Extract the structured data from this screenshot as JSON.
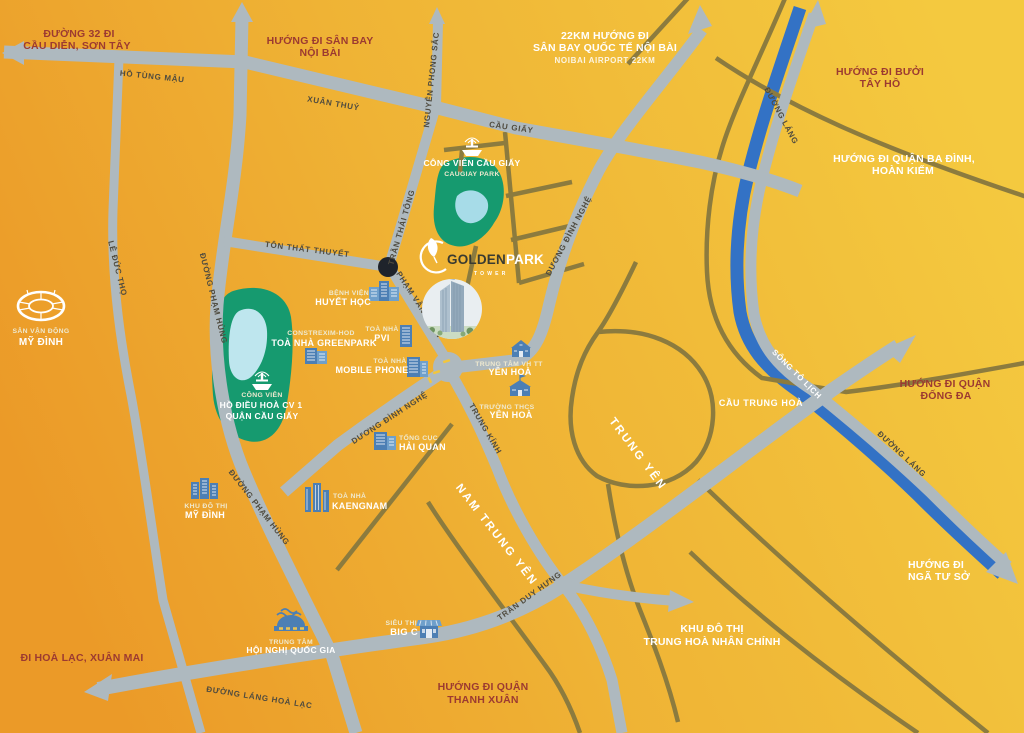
{
  "colors": {
    "bg_orange": "#EC9C2A",
    "bg_gold": "#F4C93F",
    "road_gray": "#AEB9BF",
    "road_minor_olive": "#8C7B3E",
    "river_blue": "#3372C5",
    "park_green": "#169A6F",
    "lake_blue": "#A7DCE8",
    "icon_blue": "#4C7FB4",
    "direction_red": "#9C3A31",
    "label_white": "#FFFFFF",
    "road_label_dark": "#4F4B3F",
    "junction_dot": "#1F232B"
  },
  "brand": {
    "golden": "GOLDEN",
    "park": "PARK",
    "tower": "TOWER"
  },
  "directions": {
    "route32": [
      "ĐƯỜNG 32 ĐI",
      "CẦU DIỄN, SƠN TÂY"
    ],
    "noibai": [
      "HƯỚNG ĐI SÂN BAY",
      "NỘI BÀI"
    ],
    "noibai22": [
      "22KM HƯỚNG ĐI",
      "SÂN BAY QUỐC TẾ NỘI BÀI",
      "NOIBAI AIRPORT 22KM"
    ],
    "buoi": [
      "HƯỚNG ĐI BƯỞI",
      "TÂY HỒ"
    ],
    "badinh": [
      "HƯỚNG ĐI QUẬN BA ĐÌNH,",
      "HOÀN KIẾM"
    ],
    "dongda": [
      "HƯỚNG ĐI QUẬN",
      "ĐỐNG ĐA"
    ],
    "ngatuso": [
      "HƯỚNG ĐI",
      "NGÃ TƯ SỞ"
    ],
    "trunghoa": [
      "KHU ĐÔ THỊ",
      "TRUNG HOÀ NHÂN CHÍNH"
    ],
    "thanhxuan": [
      "HƯỚNG ĐI QUẬN",
      "THANH XUÂN"
    ],
    "hoalac": [
      "ĐI HOÀ LẠC, XUÂN MAI"
    ]
  },
  "roads": {
    "ho_tung_mau": "HỒ TÙNG MẬU",
    "xuan_thuy": "XUÂN THUỶ",
    "cau_giay": "CẦU GIẤY",
    "nguyen_phong_sac": "NGUYỄN PHONG SẮC",
    "tran_thai_tong": "TRẦN THÁI TÔNG",
    "pham_van_bach": "PHẠM VĂN BẠCH",
    "ton_that_thuyet": "TÔN THẤT THUYẾT",
    "duong_dinh_nghe_1": "DƯƠNG ĐÌNH NGHỆ",
    "duong_dinh_nghe_2": "DƯƠNG ĐÌNH NGHỆ",
    "trung_kinh": "TRUNG KÍNH",
    "pham_hung_1": "ĐƯỜNG PHẠM HÙNG",
    "pham_hung_2": "ĐƯỜNG PHẠM HÙNG",
    "le_duc_tho": "LÊ ĐỨC THỌ",
    "lang_hoa_lac": "ĐƯỜNG LÁNG HOÀ LẠC",
    "tran_duy_hung": "TRẦN DUY HƯNG",
    "duong_lang_1": "ĐƯỜNG LÁNG",
    "duong_lang_2": "ĐƯỜNG LÁNG"
  },
  "waterways": {
    "song_to_lich": "SÔNG TÔ LỊCH"
  },
  "bridges": {
    "cau_trung_hoa": "CẦU TRUNG HOÀ"
  },
  "areas": {
    "nam_trung_yen": "NAM TRUNG YÊN",
    "trung_yen": "TRUNG YÊN"
  },
  "places": {
    "caugiay_park": [
      "CÔNG VIÊN CẦU GIẤY",
      "CAUGIAY PARK"
    ],
    "cv1_park": [
      "CÔNG VIÊN",
      "HỒ ĐIỀU HOÀ CV 1",
      "QUẬN CẦU GIẤY"
    ],
    "mydinh_stadium": [
      "SÂN VẬN ĐỘNG",
      "MỸ ĐÌNH"
    ],
    "huyet_hoc": [
      "BỆNH VIỆN",
      "HUYẾT HỌC"
    ],
    "greenpark": [
      "CONSTREXIM-HOD",
      "TOÀ NHÀ GREENPARK"
    ],
    "pvi": [
      "TOÀ NHÀ",
      "PVI"
    ],
    "mobile_phone": [
      "TOÀ NHÀ",
      "MOBILE PHONE"
    ],
    "vh_tt_yenhoa": [
      "TRUNG TÂM VH TT",
      "YÊN HOÀ"
    ],
    "thcs_yenhoa": [
      "TRƯỜNG THCS",
      "YÊN HOÀ"
    ],
    "hai_quan": [
      "TỔNG CỤC",
      "HẢI QUAN"
    ],
    "kdt_mydinh": [
      "KHU ĐÔ THỊ",
      "MỸ ĐÌNH"
    ],
    "kaengnam": [
      "TOÀ NHÀ",
      "KAENGNAM"
    ],
    "hoi_nghi": [
      "TRUNG TÂM",
      "HỘI NGHỊ QUỐC GIA"
    ],
    "big_c": [
      "SIÊU THỊ",
      "BIG C"
    ]
  }
}
